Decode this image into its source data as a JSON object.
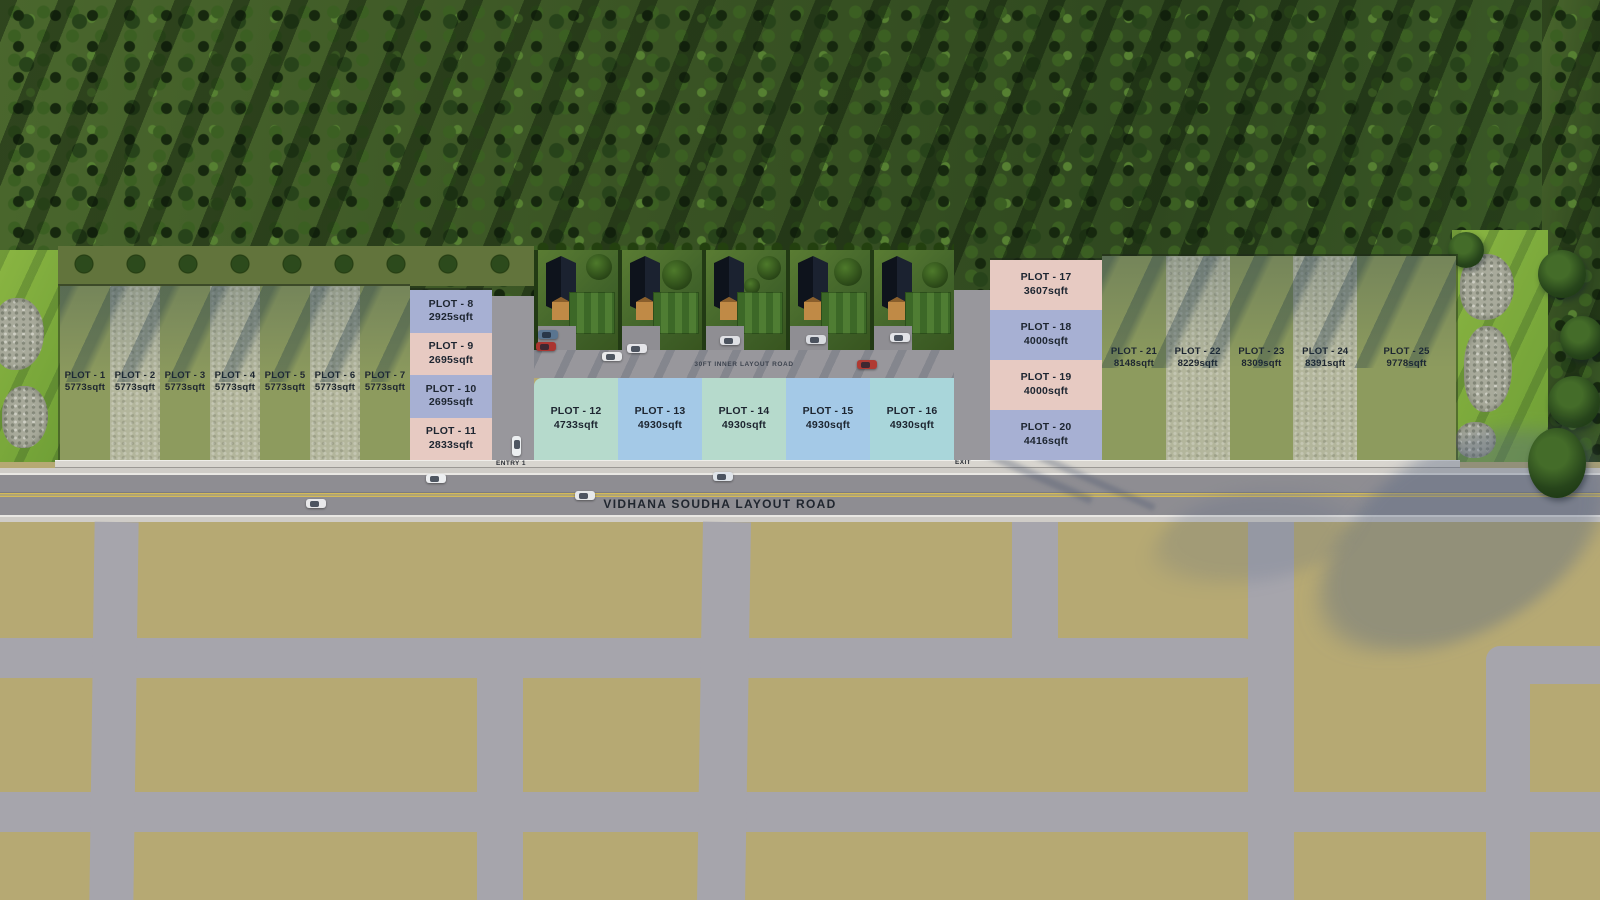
{
  "scene": {
    "main_road_label": "VIDHANA SOUDHA LAYOUT ROAD",
    "inner_road_label": "30FT INNER LAYOUT ROAD",
    "entry_label": "ENTRY 1",
    "exit_label": "EXIT"
  },
  "plots": [
    {
      "name": "PLOT - 1",
      "size": "5773sqft"
    },
    {
      "name": "PLOT - 2",
      "size": "5773sqft"
    },
    {
      "name": "PLOT - 3",
      "size": "5773sqft"
    },
    {
      "name": "PLOT - 4",
      "size": "5773sqft"
    },
    {
      "name": "PLOT - 5",
      "size": "5773sqft"
    },
    {
      "name": "PLOT - 6",
      "size": "5773sqft"
    },
    {
      "name": "PLOT - 7",
      "size": "5773sqft"
    },
    {
      "name": "PLOT - 8",
      "size": "2925sqft"
    },
    {
      "name": "PLOT - 9",
      "size": "2695sqft"
    },
    {
      "name": "PLOT - 10",
      "size": "2695sqft"
    },
    {
      "name": "PLOT - 11",
      "size": "2833sqft"
    },
    {
      "name": "PLOT - 12",
      "size": "4733sqft"
    },
    {
      "name": "PLOT - 13",
      "size": "4930sqft"
    },
    {
      "name": "PLOT - 14",
      "size": "4930sqft"
    },
    {
      "name": "PLOT - 15",
      "size": "4930sqft"
    },
    {
      "name": "PLOT - 16",
      "size": "4930sqft"
    },
    {
      "name": "PLOT - 17",
      "size": "3607sqft"
    },
    {
      "name": "PLOT - 18",
      "size": "4000sqft"
    },
    {
      "name": "PLOT - 19",
      "size": "4000sqft"
    },
    {
      "name": "PLOT - 20",
      "size": "4416sqft"
    },
    {
      "name": "PLOT - 21",
      "size": "8148sqft"
    },
    {
      "name": "PLOT - 22",
      "size": "8229sqft"
    },
    {
      "name": "PLOT - 23",
      "size": "8309sqft"
    },
    {
      "name": "PLOT - 24",
      "size": "8391sqft"
    },
    {
      "name": "PLOT - 25",
      "size": "9778sqft"
    }
  ],
  "colors": {
    "olive": "#8d9b5e",
    "khaki": "#b3b69c",
    "lavender": "#a7b0d3",
    "pink": "#e7cac2",
    "mint": "#b6dacc",
    "blue": "#a4c9e7",
    "cyan": "#a9d6da",
    "label": "#1d2530",
    "innerroad": "#98979c",
    "asphalt": "#8e8d92",
    "curb": "#cfccc7",
    "yellowline": "#d3ba58",
    "tan": "#b6a973",
    "gridroad": "#a6a5ac",
    "sidewalk": "#d8d5cf"
  }
}
